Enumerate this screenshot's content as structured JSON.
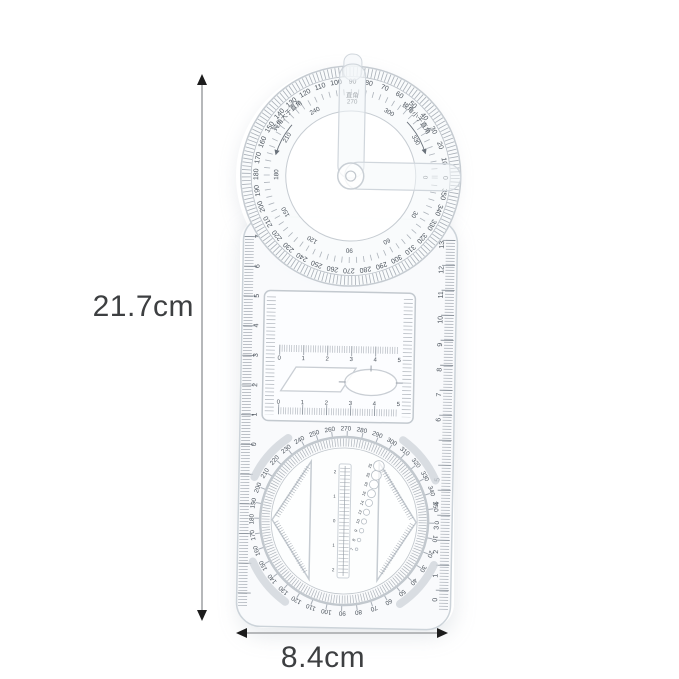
{
  "annotations": {
    "height_label": "21.7cm",
    "width_label": "8.4cm"
  },
  "colors": {
    "tick": "#8f97a0",
    "number": "#4a525b",
    "body_border": "#ccd3d9",
    "dimension_line": "#b6b8ba",
    "dimension_text": "#3d3f41",
    "arrow": "#1c1c1c"
  },
  "product": {
    "top_protractor": {
      "right_angle_label": "直角",
      "obtuse_label": "钝角大于直角",
      "acute_label": "锐角小于直角",
      "outer_labels": [
        "0",
        "10",
        "20",
        "30",
        "40",
        "50",
        "60",
        "70",
        "80",
        "90",
        "100",
        "110",
        "120",
        "130",
        "140",
        "150",
        "160",
        "170",
        "180",
        "190",
        "200",
        "210",
        "220",
        "230",
        "240",
        "250",
        "260",
        "270",
        "280",
        "290",
        "300",
        "310",
        "320",
        "330",
        "340",
        "350"
      ],
      "inner_labels": [
        "0",
        "30",
        "60",
        "90",
        "120",
        "150",
        "180",
        "210",
        "240",
        "270",
        "300",
        "330"
      ]
    },
    "middle": {
      "left_edge_numbers": [
        "0",
        "1",
        "2",
        "3",
        "4",
        "5",
        "6",
        "7"
      ],
      "right_edge_numbers": [
        "6",
        "7",
        "8",
        "9",
        "10",
        "11",
        "12",
        "13"
      ],
      "window_scale_top": [
        "0",
        "1",
        "2",
        "3",
        "4",
        "5"
      ],
      "window_scale_bottom": [
        "0",
        "1",
        "2",
        "3",
        "4",
        "5"
      ]
    },
    "bottom_dial": {
      "dial_labels": [
        "0",
        "10",
        "20",
        "30",
        "40",
        "50",
        "60",
        "70",
        "80",
        "90",
        "100",
        "110",
        "120",
        "130",
        "140",
        "150",
        "160",
        "170",
        "180",
        "190",
        "200",
        "210",
        "220",
        "230",
        "240",
        "250",
        "260",
        "270",
        "280",
        "290",
        "300",
        "310",
        "320",
        "330",
        "340",
        "350"
      ],
      "center_scale": [
        "2",
        "1",
        "0",
        "1",
        "2"
      ],
      "hole_labels": [
        "7",
        "8",
        "9",
        "10",
        "12",
        "14",
        "16",
        "18",
        "20",
        "25"
      ],
      "right_edge_numbers": [
        "0",
        "1",
        "2",
        "3",
        "4",
        "5"
      ]
    }
  }
}
